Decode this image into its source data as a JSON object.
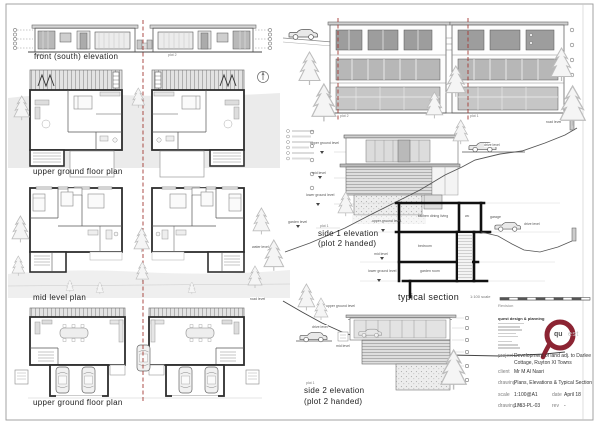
{
  "colors": {
    "accent_red": "#a33b35",
    "logo_maroon": "#8c2433",
    "wall_dark": "#2e2e2e",
    "ground_gray": "#e6e6e6"
  },
  "labels": {
    "front_elevation": "front (south) elevation",
    "upper_ground_plan": "upper ground floor plan",
    "mid_level_plan": "mid level plan",
    "lower_ground_plan": "upper ground floor plan",
    "side1_line1": "side 1 elevation",
    "side1_line2": "(plot 2 handed)",
    "side1_plot": "plot 1",
    "side2_line1": "side 2 elevation",
    "side2_line2": "(plot 2 handed)",
    "side2_plot": "plot 1",
    "typical_section": "typical section",
    "front_plot_left": "plot 1",
    "front_plot_right": "plot 2",
    "rear_plot_left": "plot 2",
    "rear_plot_right": "plot 1"
  },
  "levels": {
    "upper_ground": "upper ground level",
    "mid": "mid level",
    "lower_ground": "lower ground level",
    "garden": "garden level",
    "drive": "drive level",
    "road": "road level",
    "water": "water level"
  },
  "section_rooms": {
    "upper": "kitchen dining living",
    "wc": "wc",
    "mid": "bedroom",
    "lower": "garden room",
    "garage": "garage"
  },
  "scalebar_label": "1:100 scale",
  "titleblock": {
    "revision_label": "Revision",
    "company_name": "quest design & planning",
    "logo_qu": "qu",
    "logo_est": "est",
    "project_label": "project",
    "project_value_1": "Development of land adj. to Darlee",
    "project_value_2": "Cottage, Ruyton XI Towns",
    "client_label": "client",
    "client_value": "Mr M Al Nasri",
    "drawing_label": "drawing",
    "drawing_value": "Plans, Elevations & Typical Section",
    "scale_label": "scale",
    "scale_value": "1:100@A1",
    "date_label": "date",
    "date_value": "April 18",
    "drawingno_label": "drawing no.",
    "drawingno_value": "1763-PL-03",
    "rev_label": "rev",
    "rev_value": "-"
  }
}
